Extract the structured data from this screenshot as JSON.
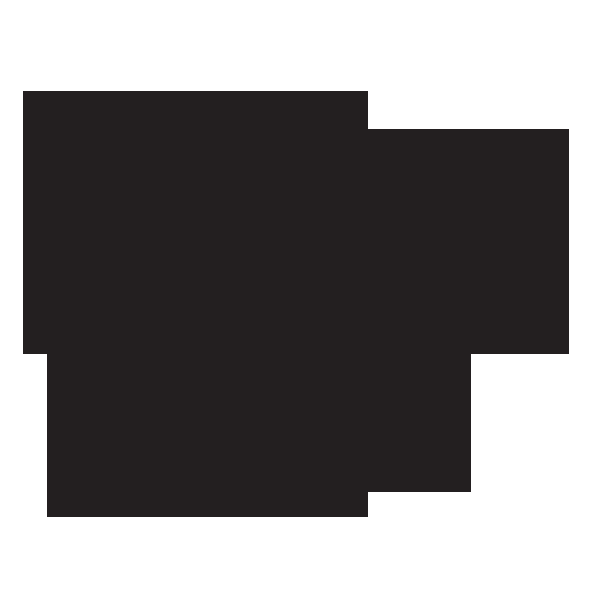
{
  "canvas": {
    "width": 600,
    "height": 600,
    "background_color": "#ffffff"
  },
  "silhouette": {
    "description": "solid dark stepped rectilinear blob silhouette",
    "fill_color": "#231f20",
    "points": "23,91 368,91 368,129 569,129 569,354 471,354 471,492 368,492 368,517 47,517 47,354 23,354"
  }
}
